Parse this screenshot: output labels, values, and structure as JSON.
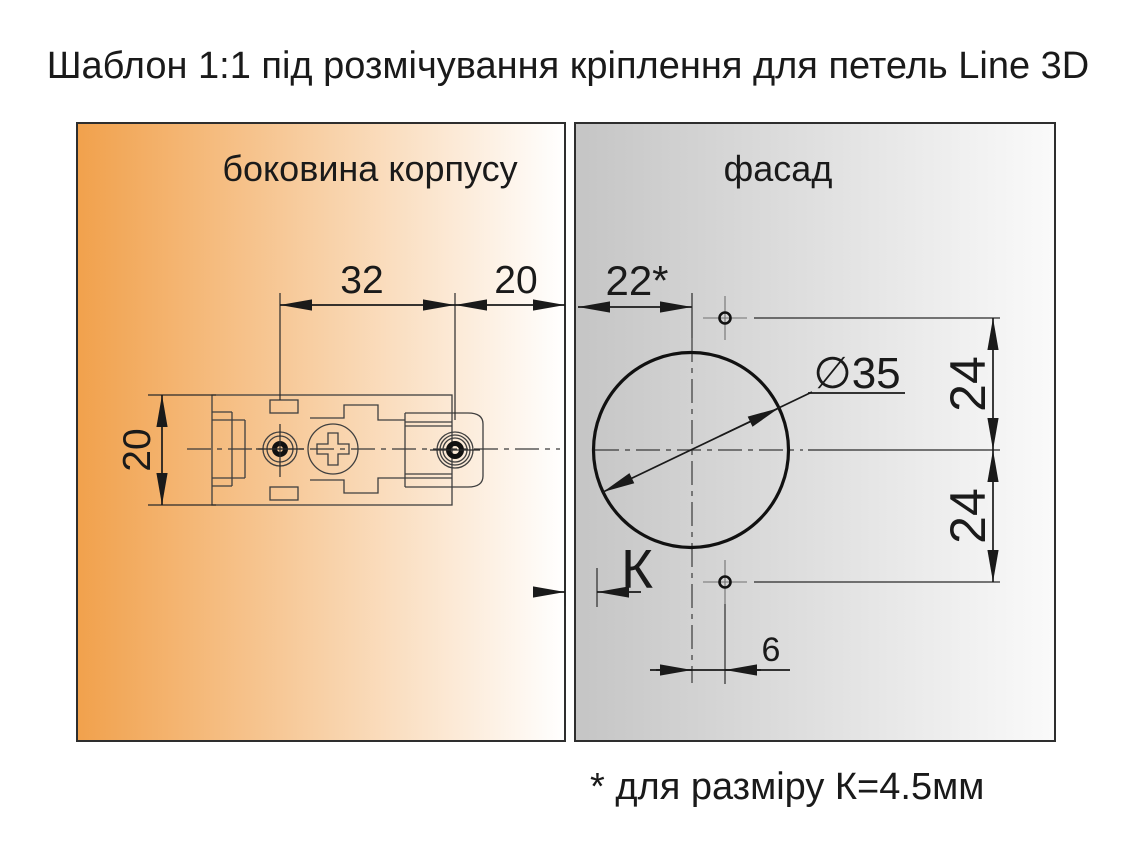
{
  "title": "Шаблон 1:1 під розмічування кріплення для петель Line 3D",
  "panels": {
    "side": {
      "label": "боковина корпусу",
      "color_start": "#F1A14C",
      "color_end": "#FFFFFF"
    },
    "facade": {
      "label": "фасад",
      "color_start": "#C5C5C5",
      "color_end": "#FAFAFA"
    }
  },
  "dims": {
    "plate_hole_spacing": "32",
    "plate_edge_offset": "20",
    "plate_height": "20",
    "facade_cup_offset": "22*",
    "cup_diameter": "∅35",
    "screw_above_center": "24",
    "screw_below_center": "24",
    "screw_horizontal_offset": "6",
    "k_gap_label": "К"
  },
  "footnote": "* для разміру К=4.5мм",
  "line_color": "#1a1a1a"
}
